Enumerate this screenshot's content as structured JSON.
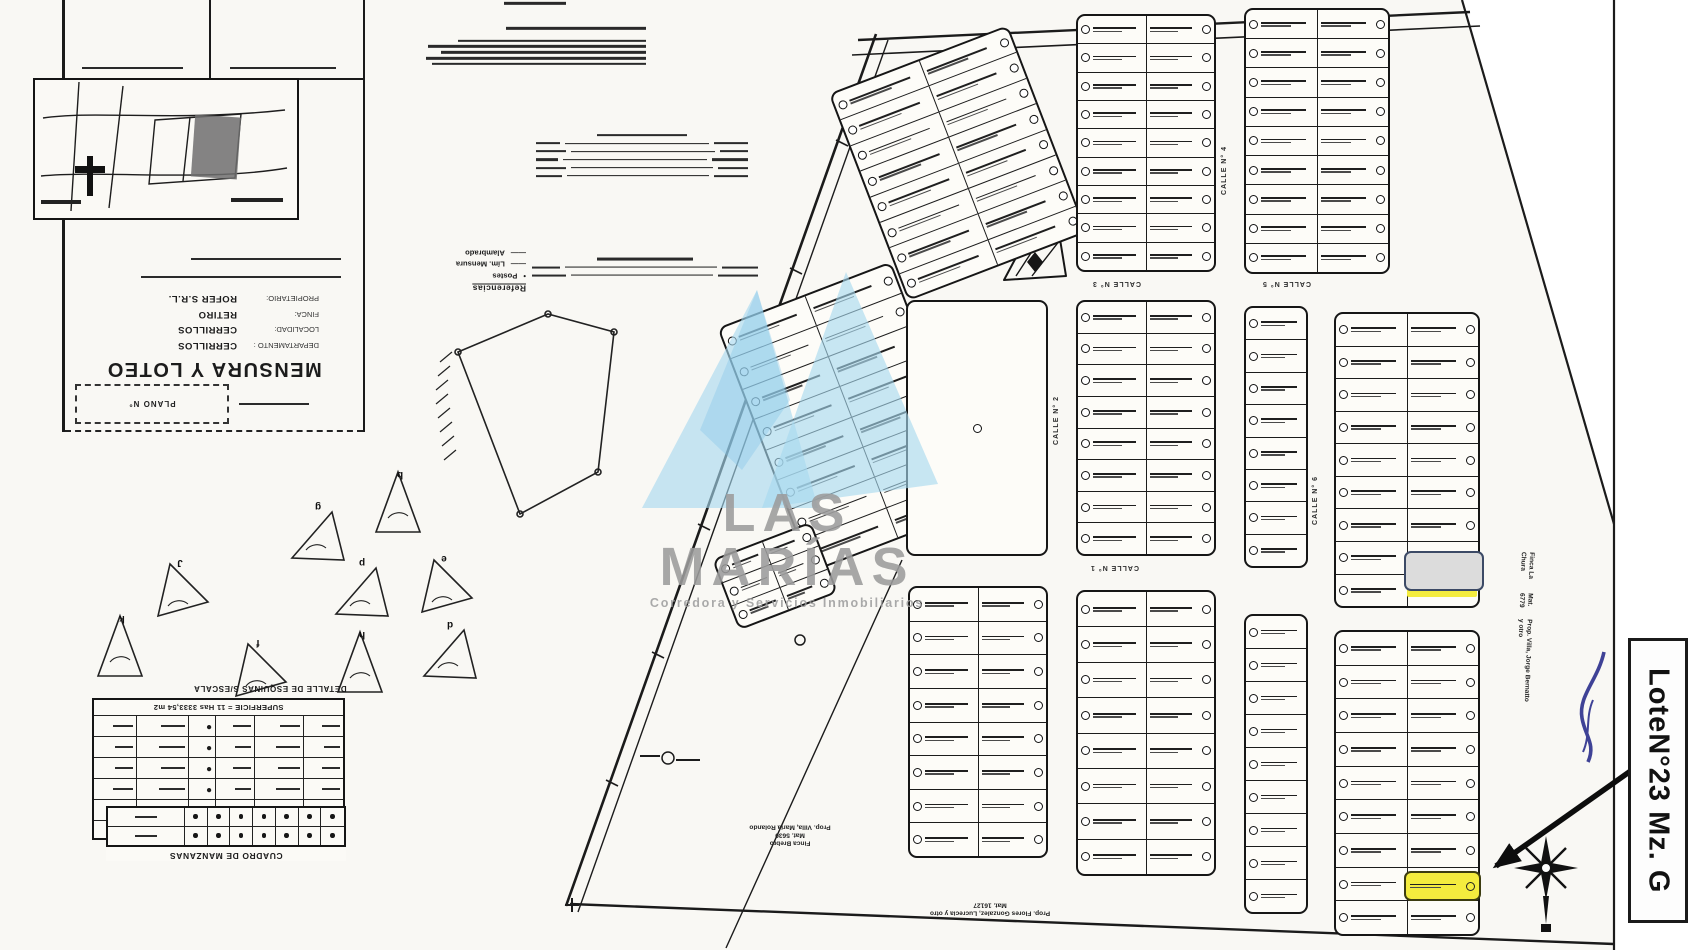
{
  "annotation": {
    "label": "LoteN°23 Mz. G"
  },
  "watermark": {
    "title": "LAS MARÍAS",
    "subtitle": "Corredora y Servicios Inmobiliarios",
    "logo_color": "#a7d9ef",
    "text_color": "#9c9c9c"
  },
  "colors": {
    "highlight_yellow": "#f4ec3e",
    "covered_gray": "#dcdcdc",
    "pen_blue": "#2b2f8c",
    "scan_bg": "#f9f8f4"
  },
  "title_block": {
    "plan_title": "MENSURA Y LOTEO",
    "plano_label": "PLANO N°",
    "fields": [
      {
        "label": "DEPARTAMENTO :",
        "value": "CERRILLOS"
      },
      {
        "label": "LOCALIDAD:",
        "value": "CERRILLOS"
      },
      {
        "label": "FINCA:",
        "value": "RETIRO"
      },
      {
        "label": "PROPIETARIO:",
        "value": "ROFER S.R.L."
      }
    ]
  },
  "tables": {
    "poligono_title": "MENSURA POLIGONO GENERAL",
    "superficie": "SUPERFICIE = 11 Has 3333,54 m2",
    "manzanas_title": "CUADRO DE MANZANAS"
  },
  "legend": {
    "title": "Referencias",
    "items": [
      {
        "symbol": "•",
        "label": "Postes"
      },
      {
        "symbol": "——",
        "label": "Lím. Mensura"
      },
      {
        "symbol": "——",
        "label": "Alambrado"
      }
    ]
  },
  "details": {
    "caption": "DETALLE DE ESQUINAS S/ESCALA",
    "items": [
      {
        "letter": "b",
        "x": 368,
        "y": 466
      },
      {
        "letter": "g",
        "x": 286,
        "y": 498
      },
      {
        "letter": "J",
        "x": 148,
        "y": 554
      },
      {
        "letter": "k",
        "x": 90,
        "y": 610
      },
      {
        "letter": "p",
        "x": 330,
        "y": 554
      },
      {
        "letter": "e",
        "x": 412,
        "y": 550
      },
      {
        "letter": "h",
        "x": 330,
        "y": 626
      },
      {
        "letter": "d",
        "x": 418,
        "y": 616
      },
      {
        "letter": "f",
        "x": 226,
        "y": 634
      }
    ]
  },
  "margin_notes": {
    "right": [
      "Finca La Chura",
      "Mat. 6779",
      "Prop. Villa, Jorge Bernatto y otro"
    ],
    "bottom_center": [
      "Finca Brebro",
      "Mat. 5630",
      "Prop. Villa, María Rolando"
    ],
    "bottom_right": [
      "Prop. Flores Gonzalez, Lucrecia y otro",
      "Mat. 16127"
    ]
  },
  "plan": {
    "streets": [
      {
        "label": "CALLE N° 1",
        "x": 1090,
        "y": 564,
        "o": "h"
      },
      {
        "label": "CALLE N° 2",
        "x": 1053,
        "y": 396,
        "o": "v"
      },
      {
        "label": "CALLE N° 3",
        "x": 1092,
        "y": 280,
        "o": "h"
      },
      {
        "label": "CALLE N° 4",
        "x": 1221,
        "y": 146,
        "o": "v"
      },
      {
        "label": "CALLE N° 5",
        "x": 1262,
        "y": 280,
        "o": "h"
      },
      {
        "label": "CALLE N° 6",
        "x": 1312,
        "y": 476,
        "o": "v"
      }
    ],
    "blocks": [
      {
        "x": 862,
        "y": 52,
        "w": 192,
        "h": 222,
        "rows": 8,
        "cols": 2,
        "rot": -21
      },
      {
        "x": 758,
        "y": 286,
        "w": 186,
        "h": 262,
        "rows": 8,
        "cols": 2,
        "rot": -21
      },
      {
        "x": 722,
        "y": 538,
        "w": 106,
        "h": 76,
        "rows": 3,
        "cols": 2,
        "rot": -21
      },
      {
        "x": 1076,
        "y": 14,
        "w": 140,
        "h": 258,
        "rows": 9,
        "cols": 2,
        "rot": 0
      },
      {
        "x": 1244,
        "y": 8,
        "w": 146,
        "h": 266,
        "rows": 9,
        "cols": 2,
        "rot": 0
      },
      {
        "x": 906,
        "y": 300,
        "w": 142,
        "h": 256,
        "rows": 0,
        "cols": 0,
        "rot": 0
      },
      {
        "x": 1076,
        "y": 300,
        "w": 140,
        "h": 256,
        "rows": 8,
        "cols": 2,
        "rot": 0
      },
      {
        "x": 1244,
        "y": 306,
        "w": 64,
        "h": 262,
        "rows": 8,
        "cols": 1,
        "rot": 0
      },
      {
        "x": 1334,
        "y": 312,
        "w": 146,
        "h": 296,
        "rows": 9,
        "cols": 2,
        "rot": 0
      },
      {
        "x": 908,
        "y": 586,
        "w": 140,
        "h": 272,
        "rows": 8,
        "cols": 2,
        "rot": 0
      },
      {
        "x": 1076,
        "y": 590,
        "w": 140,
        "h": 286,
        "rows": 8,
        "cols": 2,
        "rot": 0
      },
      {
        "x": 1244,
        "y": 614,
        "w": 64,
        "h": 300,
        "rows": 9,
        "cols": 1,
        "rot": 0
      },
      {
        "x": 1334,
        "y": 630,
        "w": 146,
        "h": 306,
        "rows": 9,
        "cols": 2,
        "rot": 0
      }
    ]
  }
}
